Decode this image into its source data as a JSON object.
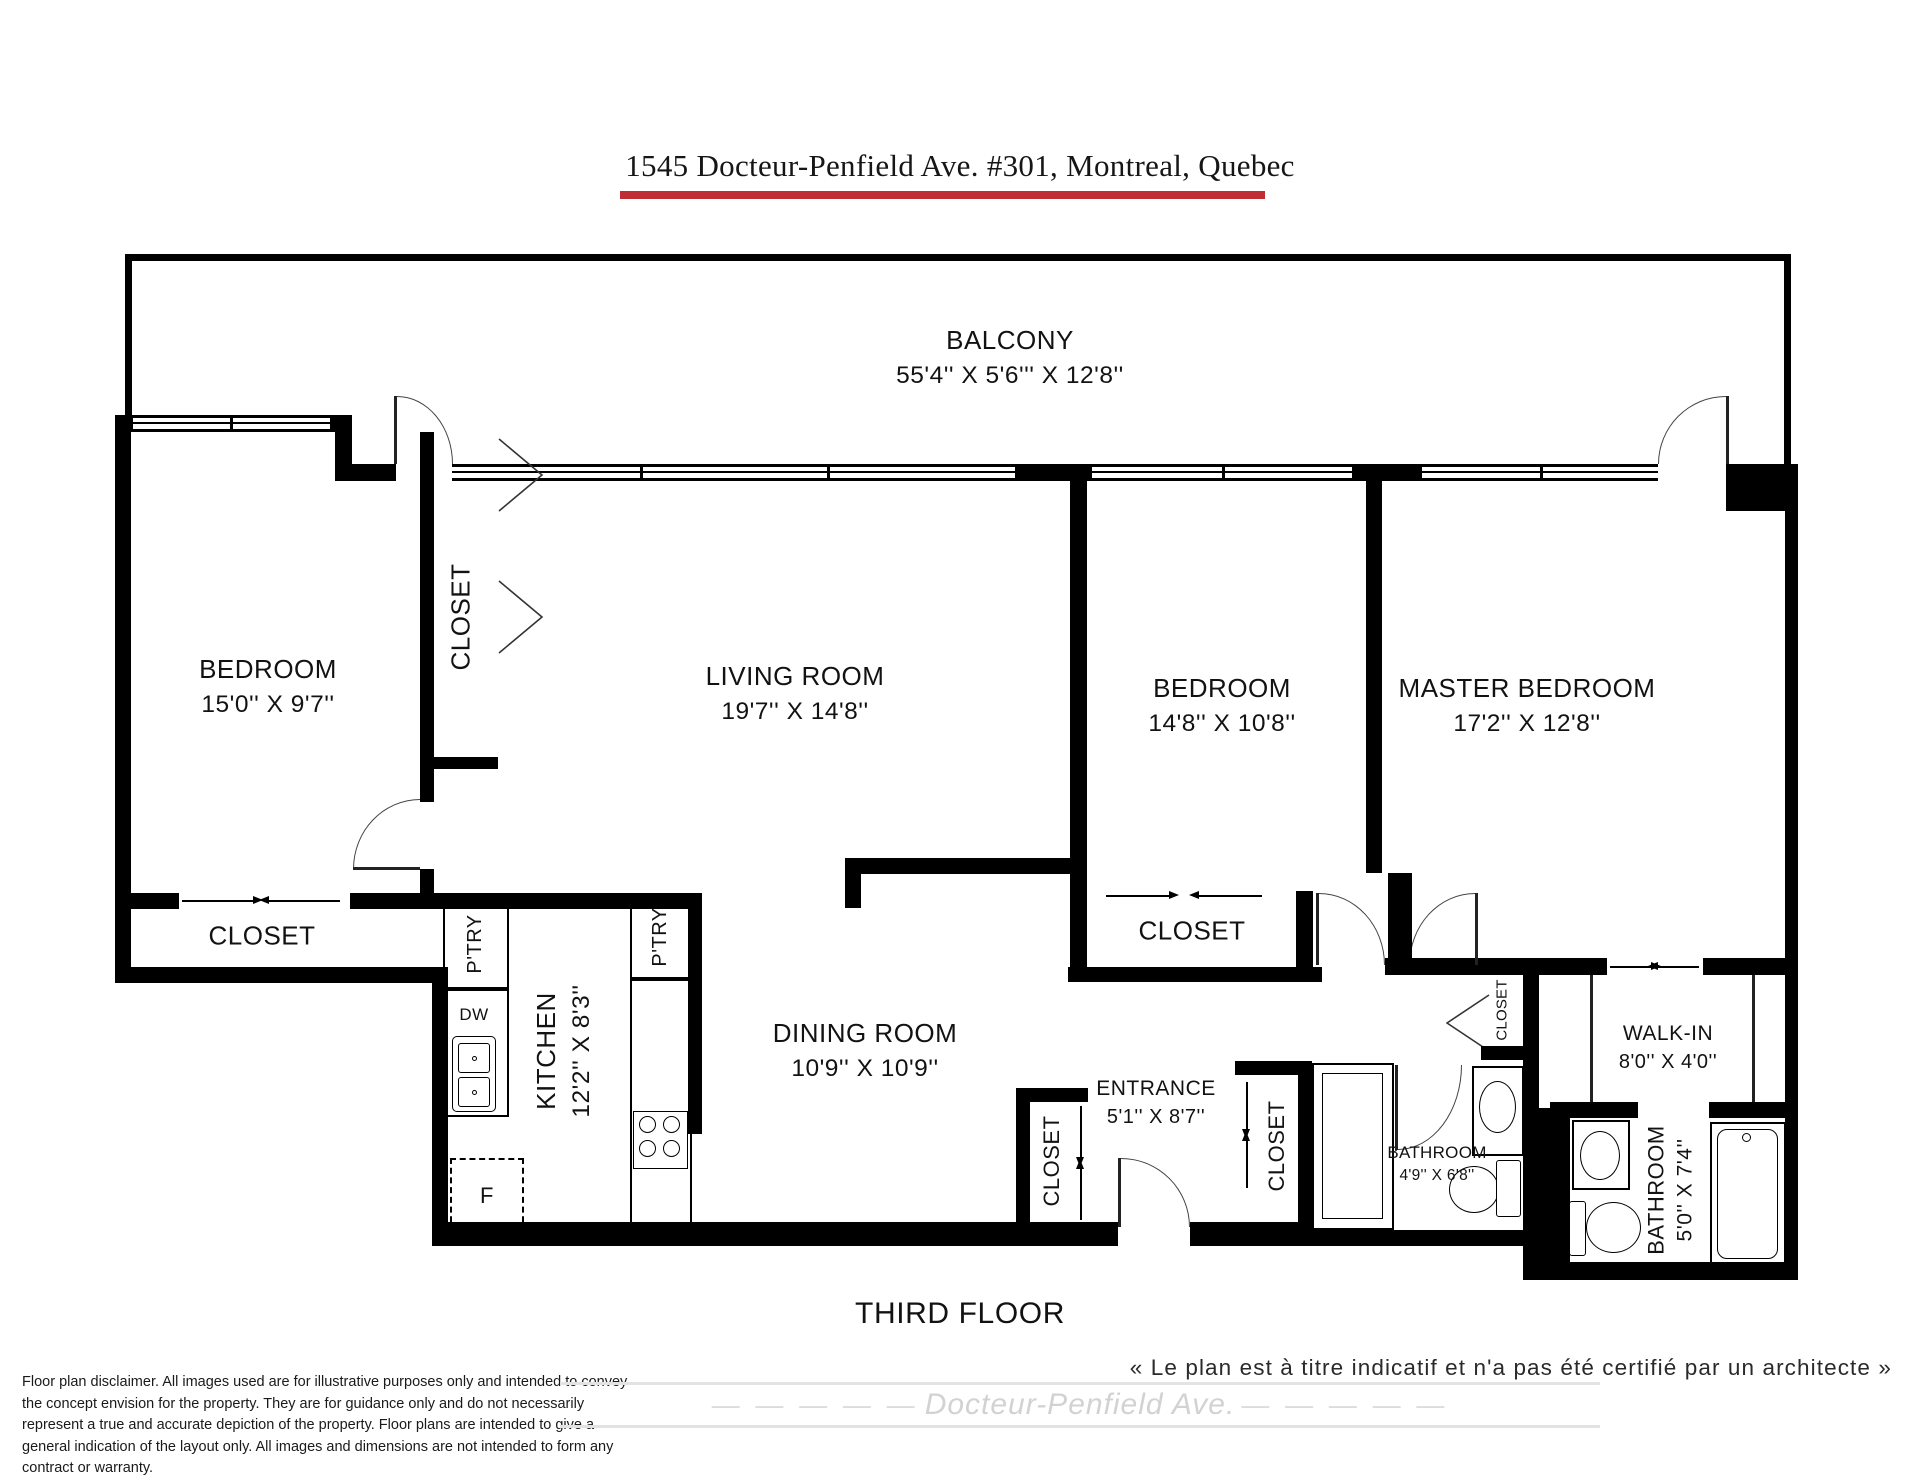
{
  "title": "1545 Docteur-Penfield Ave. #301, Montreal, Quebec",
  "accent_color": "#be2e34",
  "plan": {
    "floor_label": "THIRD FLOOR",
    "balcony": {
      "name": "BALCONY",
      "dims": "55'4'' X 5'6''' X 12'8''"
    },
    "bedroom1": {
      "name": "BEDROOM",
      "dims": "15'0'' X 9'7''"
    },
    "living_room": {
      "name": "LIVING ROOM",
      "dims": "19'7'' X 14'8''"
    },
    "bedroom2": {
      "name": "BEDROOM",
      "dims": "14'8'' X 10'8''"
    },
    "master_bedroom": {
      "name": "MASTER BEDROOM",
      "dims": "17'2'' X 12'8''"
    },
    "kitchen": {
      "name": "KITCHEN",
      "dims": "12'2'' X 8'3''"
    },
    "dining_room": {
      "name": "DINING ROOM",
      "dims": "10'9'' X 10'9''"
    },
    "entrance": {
      "name": "ENTRANCE",
      "dims": "5'1'' X 8'7''"
    },
    "walk_in": {
      "name": "WALK-IN",
      "dims": "8'0'' X 4'0''"
    },
    "bathroom_small": {
      "name": "BATHROOM",
      "dims": "4'9'' X 6'8''"
    },
    "bathroom_main": {
      "name": "BATHROOM",
      "dims": "5'0'' X 7'4''"
    },
    "closet_label": "CLOSET",
    "pantry_label": "P'TRY",
    "dishwasher_label": "DW",
    "fridge_label": "F"
  },
  "footer": {
    "disclaimer": "Floor plan disclaimer. All images used are for illustrative purposes only and intended to convey the concept envision for the property. They are for guidance only and do not necessarily represent a true and accurate depiction of the property. Floor plans are intended to give a general indication of the layout only. All images and dimensions are not intended to form any contract or warranty.",
    "architect_note": "« Le plan est à titre indicatif et n'a pas été certifié par un architecte »",
    "street_dashes_left": "—  —  —  —  —",
    "street_name": "Docteur-Penfield Ave.",
    "street_dashes_right": "—  —  —  —  —"
  }
}
